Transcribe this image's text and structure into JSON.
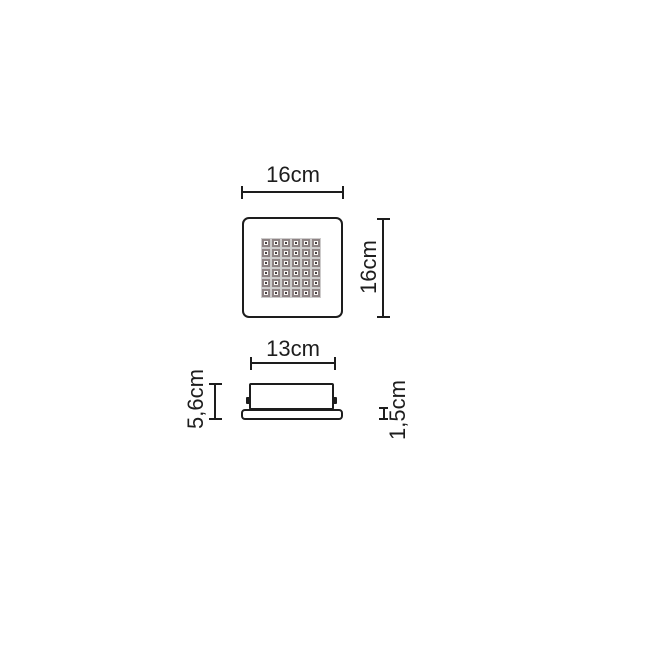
{
  "top_view": {
    "width_label": "16cm",
    "height_label": "16cm",
    "led_grid": {
      "rows": 6,
      "cols": 6
    }
  },
  "side_view": {
    "width_label": "13cm",
    "height_label": "5,6cm",
    "base_thickness_label": "1,5cm"
  },
  "colors": {
    "line": "#1d1d1d",
    "led_frame": "#8e8384",
    "led_center": "#4a4243",
    "background": "#ffffff"
  }
}
